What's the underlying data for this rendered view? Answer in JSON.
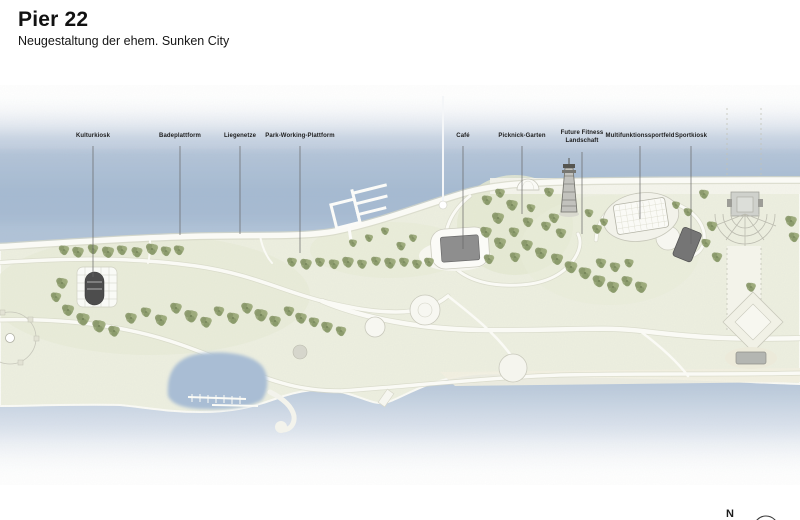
{
  "header": {
    "title": "Pier 22",
    "subtitle": "Neugestaltung der ehem. Sunken City"
  },
  "plan": {
    "labels": [
      {
        "id": "kulturkiosk",
        "text": "Kulturkiosk"
      },
      {
        "id": "badeplattform",
        "text": "Badeplattform"
      },
      {
        "id": "liegenetze",
        "text": "Liegenetze"
      },
      {
        "id": "park-working-plattform",
        "text": "Park-Working-Plattform"
      },
      {
        "id": "cafe",
        "text": "Café"
      },
      {
        "id": "picknick-garten",
        "text": "Picknick-Garten"
      },
      {
        "id": "future-fitness-landschaft",
        "text": "Future Fitness Landschaft"
      },
      {
        "id": "multifunktionssportfeld",
        "text": "Multifunktionssportfeld"
      },
      {
        "id": "sportkiosk",
        "text": "Sportkiosk"
      }
    ],
    "compass": {
      "label": "N"
    }
  },
  "colors": {
    "water": "#a9bdd4",
    "water_light": "#ccd7e5",
    "land": "#edefe0",
    "lawn": "#e5e9d2",
    "tree": "#93a274",
    "path": "#fafaf5",
    "building_dark": "#4d4d4d",
    "building_mid": "#8e8e8e",
    "building_light": "#cfd1cc",
    "leader_line": "#666666"
  }
}
